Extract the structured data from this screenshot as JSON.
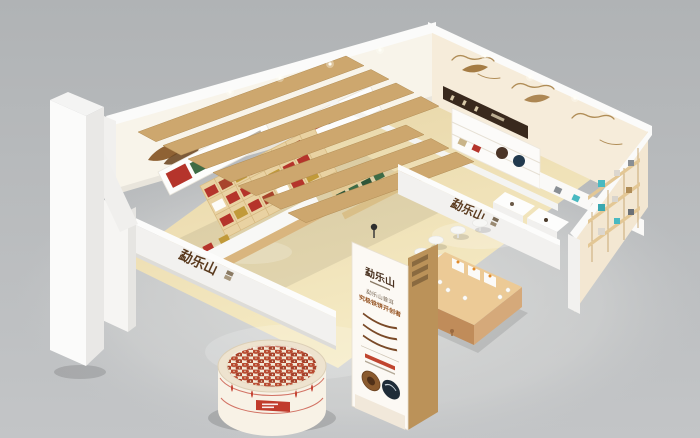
{
  "scene": {
    "description": "3D isometric render of a tea-brand exhibition shop booth"
  },
  "brand": {
    "name": "勐乐山"
  },
  "signs": {
    "front_left": "勐乐山",
    "center": "勐乐山"
  },
  "poster": {
    "logo": "勐乐山",
    "line1": "勐乐山普洱",
    "line2": "究极铁饼开创者"
  },
  "colors": {
    "backdrop": "#b6b9bb",
    "floor_wood": "#eddcae",
    "wall_cream": "#f8f4ea",
    "wall_beige": "#f6ecda",
    "wall_beige_shaded": "#f3e7d2",
    "slat_wood": "#cda76e",
    "column_wood": "#bb9259",
    "counter_wood": "#d9b57e",
    "accent_red": "#b5342b",
    "accent_green": "#3e6b45",
    "accent_teal": "#49b9c1",
    "gold_line": "#b08d57",
    "sign_bronze": "#5a3a1e",
    "white_structure": "#f2f1ef"
  }
}
